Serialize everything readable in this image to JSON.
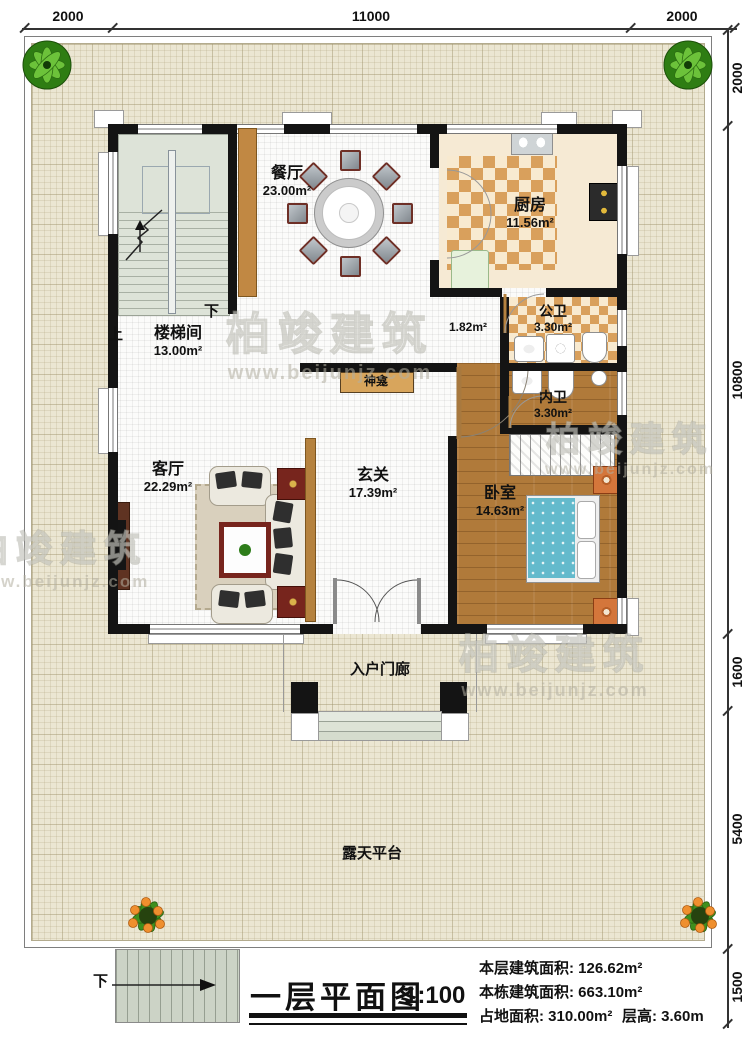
{
  "dims": {
    "top": [
      "2000",
      "11000",
      "2000"
    ],
    "right": [
      "2000",
      "10800",
      "1600",
      "5400",
      "1500"
    ]
  },
  "rooms": {
    "stairwell": {
      "name": "楼梯间",
      "area": "13.00m²"
    },
    "dining": {
      "name": "餐厅",
      "area": "23.00m²"
    },
    "kitchen": {
      "name": "厨房",
      "area": "11.56m²"
    },
    "public_bath": {
      "name": "公卫",
      "area": "3.30m²"
    },
    "inner_bath": {
      "name": "内卫",
      "area": "3.30m²"
    },
    "hallway": {
      "area": "1.82m²"
    },
    "living": {
      "name": "客厅",
      "area": "22.29m²"
    },
    "entry": {
      "name": "玄关",
      "area": "17.39m²"
    },
    "bedroom": {
      "name": "卧室",
      "area": "14.63m²"
    },
    "shrine": {
      "name": "神龛"
    },
    "porch": {
      "name": "入户门廊"
    },
    "terrace": {
      "name": "露天平台"
    }
  },
  "stairs": {
    "up": "上",
    "down": "下",
    "outdoor_down": "下"
  },
  "title_block": {
    "title": "一层平面图",
    "scale": "1:100",
    "stats": {
      "floor_area": "本层建筑面积: 126.62m²",
      "building_area": "本栋建筑面积: 663.10m²",
      "land_area": "占地面积: 310.00m²",
      "story_height": "层高: 3.60m"
    }
  },
  "watermark": {
    "brand": "柏竣建筑",
    "url": "www.beijunjz.com"
  },
  "colors": {
    "wall": "#141414",
    "wood": "#b07a3a",
    "checker": "#d9a05c",
    "terrace": "#ebe6d2",
    "stair_floor": "#dde3d8",
    "bed": "#64bacc"
  }
}
